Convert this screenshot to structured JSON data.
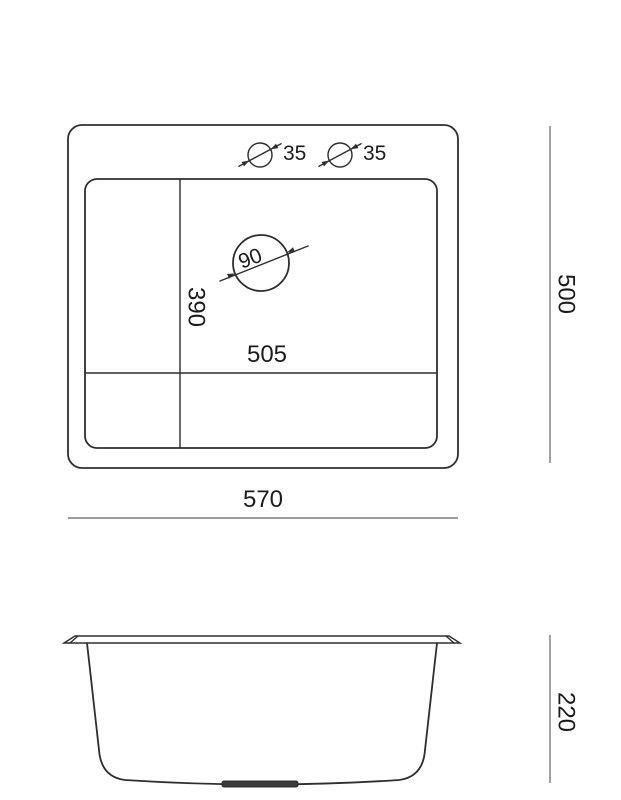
{
  "colors": {
    "line": "#2e2e2e",
    "dimension_line": "#7a7a7a",
    "text": "#1b1b1b",
    "drain_fill": "#3a3a3a",
    "background": "#ffffff"
  },
  "top_view": {
    "tap_hole_1_diameter": "35",
    "tap_hole_2_diameter": "35",
    "drain_diameter": "90",
    "inner_length": "505",
    "inner_width": "390",
    "overall_length": "570",
    "overall_width": "500"
  },
  "side_view": {
    "depth": "220"
  }
}
